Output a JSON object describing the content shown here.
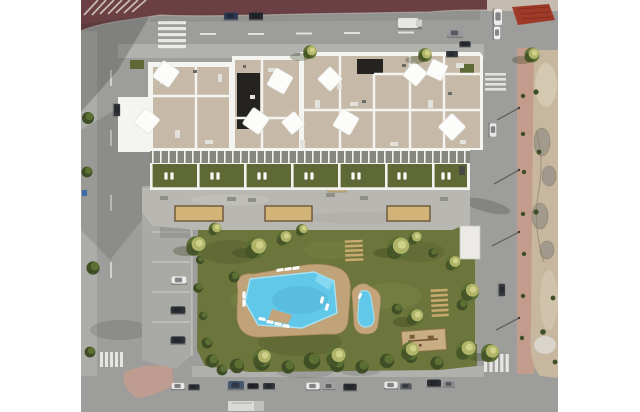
{
  "meta": {
    "type": "aerial-render-photograph",
    "description": "Top-down aerial 3D render of a white apartment complex with beige gravel rooftops and white shade sails, private ground-floor gardens, a communal grey deck with sand pergola beds, a large landscaped lawn with a free-form main pool and a small kids pool on a tan stone deck, rows of sun loungers, a wooden playground, palm trees, surrounding streets with parked cars and crosswalks, a paved red plaza at top, and a rocky vacant lot along the right side. White letterbox margins on left and right."
  },
  "scene": {
    "letterbox": {
      "left_margin": true,
      "right_margin": true
    },
    "areas": [
      "red-plaza-top",
      "main-road-top",
      "left-road",
      "right-road",
      "bottom-road",
      "apartment-building",
      "rooftop-terraces",
      "ground-floor-gardens",
      "communal-deck",
      "garden-lawn",
      "main-pool",
      "kids-pool",
      "parking-strip",
      "rocky-vacant-lot",
      "right-sidewalk"
    ],
    "inventory": {
      "shade_sails": 10,
      "rooftop_dark_sections": 2,
      "ground_floor_garden_units": 7,
      "sand_pergola_beds": 3,
      "pools": 2,
      "sun_lounger_rows": 2,
      "playgrounds": 1,
      "crosswalks": 4,
      "parking_strip_cars": 3,
      "bottom_street_parked_cars": 12,
      "moving_vehicles_top": 6,
      "trucks": 2,
      "street_lamps_right": 4,
      "red_awning_structures": 1
    }
  },
  "colors": {
    "margin": "#ffffff",
    "road": "#9d9d9b",
    "roadLight": "#b4b4b0",
    "sidewalkPink": "#c49c8e",
    "parking": "#a9a9a5",
    "redPlaza": "#6b4044",
    "redAwning": "#a03a28",
    "building": "#f4f4f1",
    "roof": "#c6b9a7",
    "roofDark": "#24231f",
    "deck": "#b8b7b2",
    "terrace": "#5f6936",
    "grass": "#6c753c",
    "grassDark": "#4c5527",
    "grassLight": "#87914e",
    "pool": "#62c8e9",
    "poolRim": "#a7e3f2",
    "poolDeck": "#c3a47b",
    "wood": "#c8a96e",
    "sand": "#d2b478",
    "sandBorder": "#6b5538",
    "treeGreen": "#5d7034",
    "treeDark": "#3f4e24",
    "palmYellow": "#b0b468",
    "palmLight": "#cfd08a",
    "rocky": "#c6b79e",
    "rockyLight": "#d8ccb4",
    "boulder": "#a19a8d",
    "rubble": "#d9d5cd",
    "carWhite": "#e9e9e7",
    "carDark": "#31353a",
    "shadow": "#2e2e2c",
    "lamp": "#4a4a46",
    "bin": "#3e6ca6"
  }
}
